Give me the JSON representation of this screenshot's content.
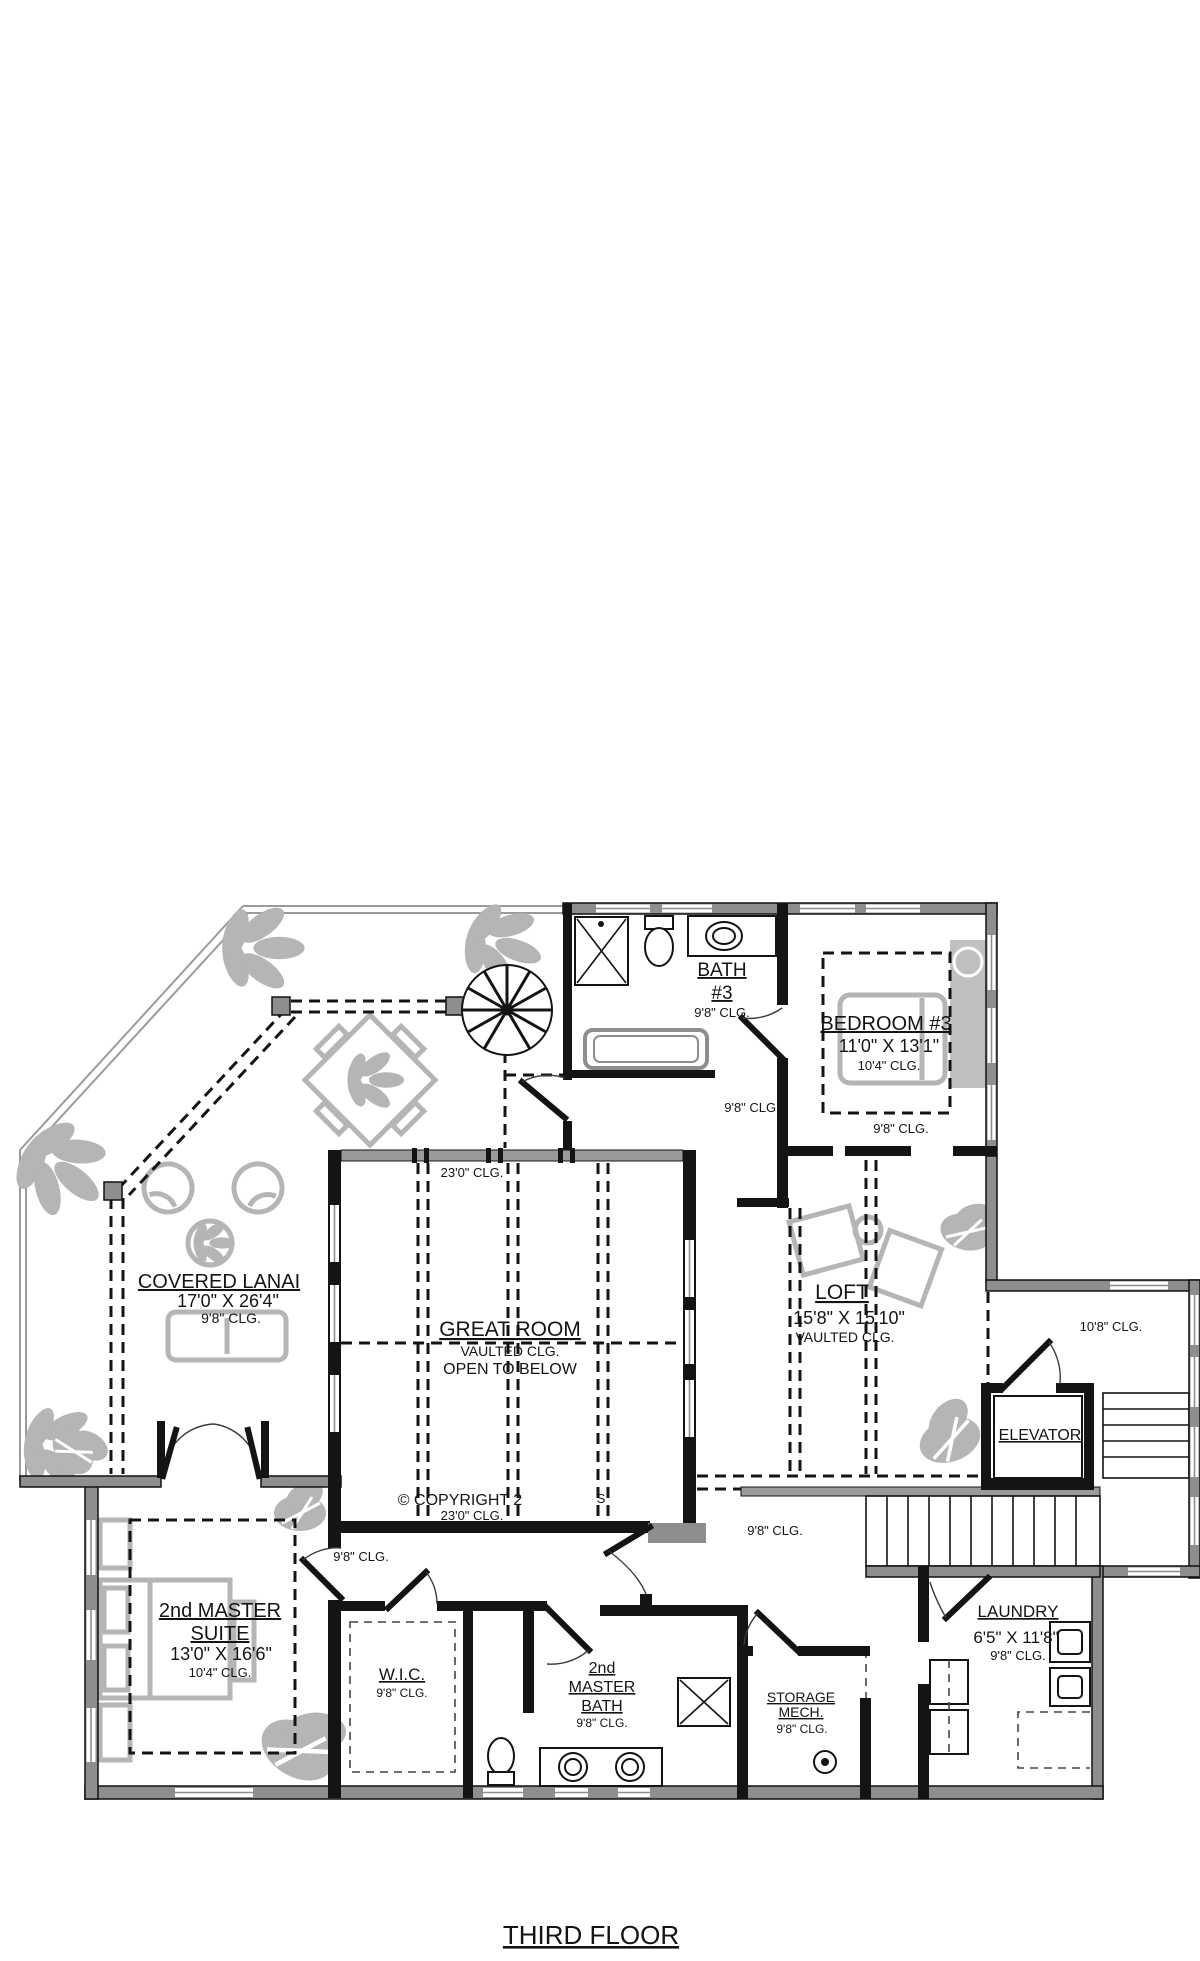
{
  "drawing": {
    "title": "THIRD FLOOR",
    "copyright_fragment": "© COPYRIGHT 2",
    "copyright_fragment2": "S",
    "colors": {
      "wall": "#141414",
      "poche": "#8e8e8e",
      "furniture": "#b5b5b5",
      "text": "#141414"
    },
    "rooms": [
      {
        "name": "COVERED LANAI",
        "dims": "17'0\" X 26'4\"",
        "ceiling": "9'8\" CLG."
      },
      {
        "name": "GREAT ROOM",
        "note1": "VAULTED CLG.",
        "note2": "OPEN TO BELOW"
      },
      {
        "name": "BATH #3",
        "ceiling": "9'8\" CLG."
      },
      {
        "name": "BEDROOM #3",
        "dims": "11'0\" X 13'1\"",
        "ceiling": "10'4\" CLG."
      },
      {
        "name": "LOFT",
        "dims": "15'8\" X 15'10\"",
        "ceiling": "VAULTED CLG."
      },
      {
        "name": "ELEVATOR"
      },
      {
        "name": "LAUNDRY",
        "dims": "6'5\" X 11'8\"",
        "ceiling": "9'8\" CLG."
      },
      {
        "name": "2nd MASTER SUITE",
        "dims": "13'0\" X 16'6\"",
        "ceiling": "10'4\" CLG."
      },
      {
        "name": "W.I.C.",
        "ceiling": "9'8\" CLG."
      },
      {
        "name": "2nd MASTER BATH",
        "ceiling": "9'8\" CLG."
      },
      {
        "name": "STORAGE MECH.",
        "ceiling": "9'8\" CLG."
      }
    ],
    "ceiling_notes": [
      "23'0\" CLG.",
      "23'0\" CLG.",
      "9'8\" CLG.",
      "9'8\" CLG.",
      "10'8\" CLG.",
      "9'8\" CLG.",
      "9'8\" CLG."
    ],
    "labels": [
      {
        "id": "bath3-name1",
        "text": "BATH",
        "x": 722,
        "y": 976,
        "size": 19,
        "ul": true
      },
      {
        "id": "bath3-name2",
        "text": "#3",
        "x": 722,
        "y": 999,
        "size": 19,
        "ul": true
      },
      {
        "id": "bath3-clg",
        "text": "9'8\" CLG.",
        "x": 722,
        "y": 1017,
        "size": 13
      },
      {
        "id": "bedroom3-name",
        "text": "BEDROOM #3",
        "x": 886,
        "y": 1030,
        "size": 20,
        "ul": true
      },
      {
        "id": "bedroom3-dims",
        "text": "11'0\" X 13'1\"",
        "x": 889,
        "y": 1052,
        "size": 18
      },
      {
        "id": "bedroom3-clg",
        "text": "10'4\" CLG.",
        "x": 889,
        "y": 1070,
        "size": 13
      },
      {
        "id": "bedroom3-clg2",
        "text": "9'8\" CLG.",
        "x": 901,
        "y": 1133,
        "size": 13
      },
      {
        "id": "hall-top-clg",
        "text": "9'8\" CLG.",
        "x": 752,
        "y": 1112,
        "size": 13
      },
      {
        "id": "greatroom-clg-top",
        "text": "23'0\" CLG.",
        "x": 472,
        "y": 1177,
        "size": 13
      },
      {
        "id": "greatroom-name",
        "text": "GREAT ROOM",
        "x": 510,
        "y": 1336,
        "size": 21,
        "ul": true
      },
      {
        "id": "greatroom-note1",
        "text": "VAULTED CLG.",
        "x": 510,
        "y": 1356,
        "size": 14
      },
      {
        "id": "greatroom-note2",
        "text": "OPEN TO BELOW",
        "x": 510,
        "y": 1374,
        "size": 16
      },
      {
        "id": "lanai-name",
        "text": "COVERED LANAI",
        "x": 219,
        "y": 1288,
        "size": 20,
        "ul": true
      },
      {
        "id": "lanai-dims",
        "text": "17'0\" X 26'4\"",
        "x": 228,
        "y": 1307,
        "size": 18
      },
      {
        "id": "lanai-clg",
        "text": "9'8\" CLG.",
        "x": 231,
        "y": 1323,
        "size": 14
      },
      {
        "id": "loft-name",
        "text": "LOFT",
        "x": 842,
        "y": 1299,
        "size": 21,
        "ul": true
      },
      {
        "id": "loft-dims",
        "text": "15'8\" X 15'10\"",
        "x": 849,
        "y": 1324,
        "size": 18
      },
      {
        "id": "loft-clg",
        "text": "VAULTED CLG.",
        "x": 845,
        "y": 1342,
        "size": 14
      },
      {
        "id": "elev-room-clg",
        "text": "10'8\" CLG.",
        "x": 1111,
        "y": 1331,
        "size": 13
      },
      {
        "id": "elevator-name",
        "text": "ELEVATOR",
        "x": 1040,
        "y": 1440,
        "size": 16,
        "ul": true
      },
      {
        "id": "copyright",
        "text": "© COPYRIGHT 2",
        "x": 460,
        "y": 1505,
        "size": 16
      },
      {
        "id": "copyright-frag",
        "text": "S",
        "x": 601,
        "y": 1503,
        "size": 13
      },
      {
        "id": "greatroom-clg-bottom",
        "text": "23'0\" CLG.",
        "x": 472,
        "y": 1520,
        "size": 13
      },
      {
        "id": "hall-left-clg",
        "text": "9'8\" CLG.",
        "x": 361,
        "y": 1561,
        "size": 13
      },
      {
        "id": "hall-right-clg",
        "text": "9'8\" CLG.",
        "x": 775,
        "y": 1535,
        "size": 13
      },
      {
        "id": "suite-name1",
        "text": "2nd MASTER",
        "x": 220,
        "y": 1617,
        "size": 20,
        "ul": true
      },
      {
        "id": "suite-name2",
        "text": "SUITE",
        "x": 220,
        "y": 1640,
        "size": 20,
        "ul": true
      },
      {
        "id": "suite-dims",
        "text": "13'0\" X 16'6\"",
        "x": 221,
        "y": 1660,
        "size": 18
      },
      {
        "id": "suite-clg",
        "text": "10'4\" CLG.",
        "x": 220,
        "y": 1677,
        "size": 13
      },
      {
        "id": "wic-name",
        "text": "W.I.C.",
        "x": 402,
        "y": 1680,
        "size": 17,
        "ul": true
      },
      {
        "id": "wic-clg",
        "text": "9'8\" CLG.",
        "x": 402,
        "y": 1697,
        "size": 12
      },
      {
        "id": "mbath-name1",
        "text": "2nd",
        "x": 602,
        "y": 1673,
        "size": 16,
        "ul": true
      },
      {
        "id": "mbath-name2",
        "text": "MASTER",
        "x": 602,
        "y": 1692,
        "size": 16,
        "ul": true
      },
      {
        "id": "mbath-name3",
        "text": "BATH",
        "x": 602,
        "y": 1711,
        "size": 16,
        "ul": true
      },
      {
        "id": "mbath-clg",
        "text": "9'8\" CLG.",
        "x": 602,
        "y": 1727,
        "size": 12
      },
      {
        "id": "storage-name1",
        "text": "STORAGE",
        "x": 801,
        "y": 1702,
        "size": 14,
        "ul": true
      },
      {
        "id": "storage-name2",
        "text": "MECH.",
        "x": 801,
        "y": 1717,
        "size": 14,
        "ul": true
      },
      {
        "id": "storage-clg",
        "text": "9'8\" CLG.",
        "x": 802,
        "y": 1733,
        "size": 12
      },
      {
        "id": "laundry-name",
        "text": "LAUNDRY",
        "x": 1018,
        "y": 1617,
        "size": 17,
        "ul": true
      },
      {
        "id": "laundry-dims",
        "text": "6'5\" X 11'8\"",
        "x": 1016,
        "y": 1643,
        "size": 17
      },
      {
        "id": "laundry-clg",
        "text": "9'8\" CLG.",
        "x": 1018,
        "y": 1660,
        "size": 13
      },
      {
        "id": "sheet-title",
        "text": "THIRD FLOOR",
        "x": 591,
        "y": 1944,
        "size": 26,
        "ul": true
      }
    ]
  }
}
